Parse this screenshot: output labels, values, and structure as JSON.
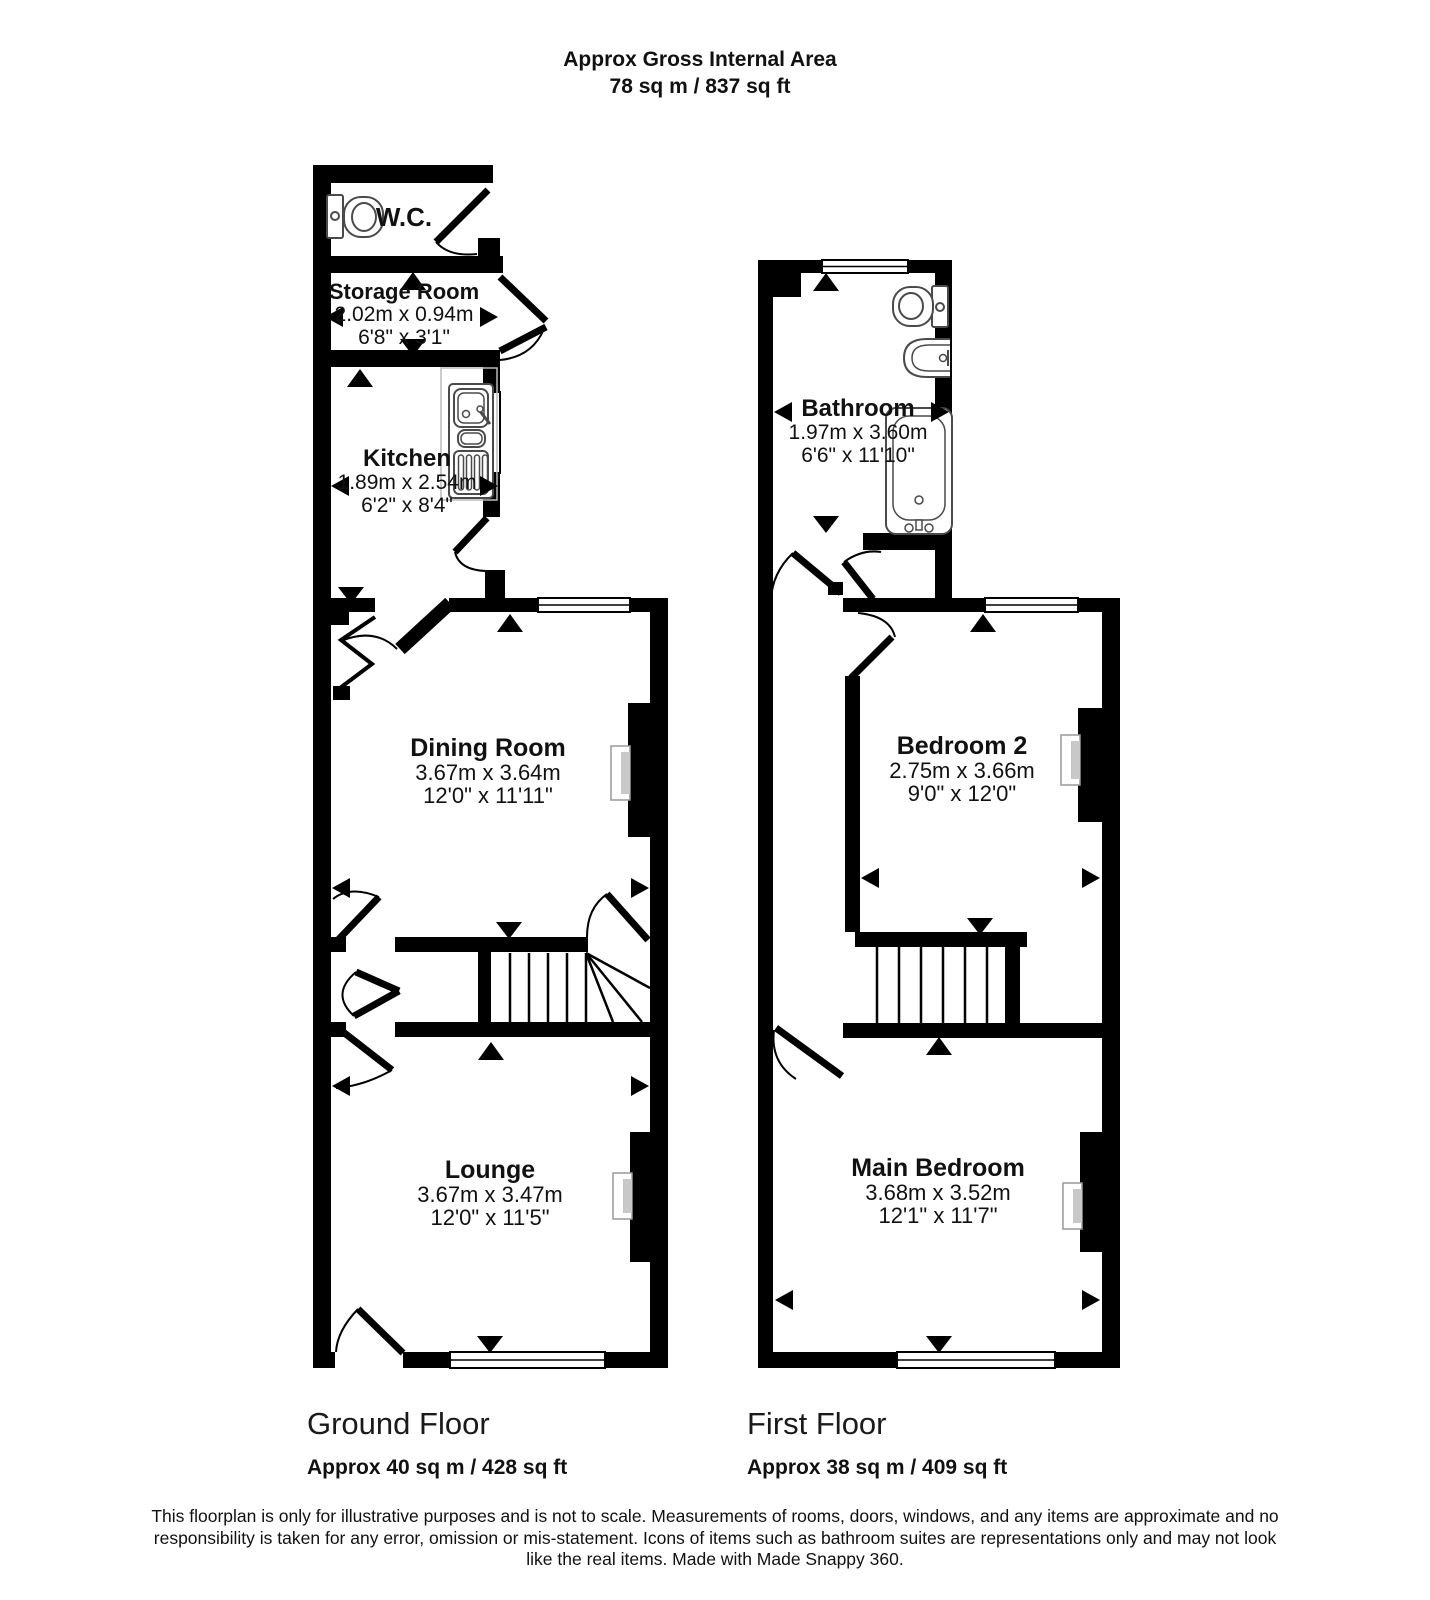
{
  "title": {
    "line1": "Approx Gross Internal Area",
    "line2": "78 sq m / 837 sq ft"
  },
  "floors": [
    {
      "name": "Ground Floor",
      "area": "Approx 40 sq m / 428 sq ft",
      "rooms": [
        {
          "name": "W.C."
        },
        {
          "name": "Storage Room",
          "metric": "2.02m x 0.94m",
          "imperial": "6'8\" x 3'1\""
        },
        {
          "name": "Kitchen",
          "metric": "1.89m x 2.54m",
          "imperial": "6'2\" x 8'4\""
        },
        {
          "name": "Dining Room",
          "metric": "3.67m x 3.64m",
          "imperial": "12'0\" x 11'11\""
        },
        {
          "name": "Lounge",
          "metric": "3.67m x 3.47m",
          "imperial": "12'0\" x 11'5\""
        }
      ]
    },
    {
      "name": "First Floor",
      "area": "Approx 38 sq m / 409 sq ft",
      "rooms": [
        {
          "name": "Bathroom",
          "metric": "1.97m x 3.60m",
          "imperial": "6'6\" x 11'10\""
        },
        {
          "name": "Bedroom 2",
          "metric": "2.75m x 3.66m",
          "imperial": "9'0\" x 12'0\""
        },
        {
          "name": "Main Bedroom",
          "metric": "3.68m x 3.52m",
          "imperial": "12'1\" x 11'7\""
        }
      ]
    }
  ],
  "disclaimer": "This floorplan is only for illustrative purposes and is not to scale. Measurements of rooms, doors, windows, and any items are approximate and no responsibility is taken for any error, omission or mis-statement. Icons of items such as bathroom suites are representations only and may not look like the real items. Made with Made Snappy 360.",
  "colors": {
    "wall": "#000000",
    "background": "#ffffff",
    "fixture_stroke": "#4a4a4a",
    "counter_stroke": "#bbbbbb",
    "fireplace_fill": "#c8c8c8"
  }
}
